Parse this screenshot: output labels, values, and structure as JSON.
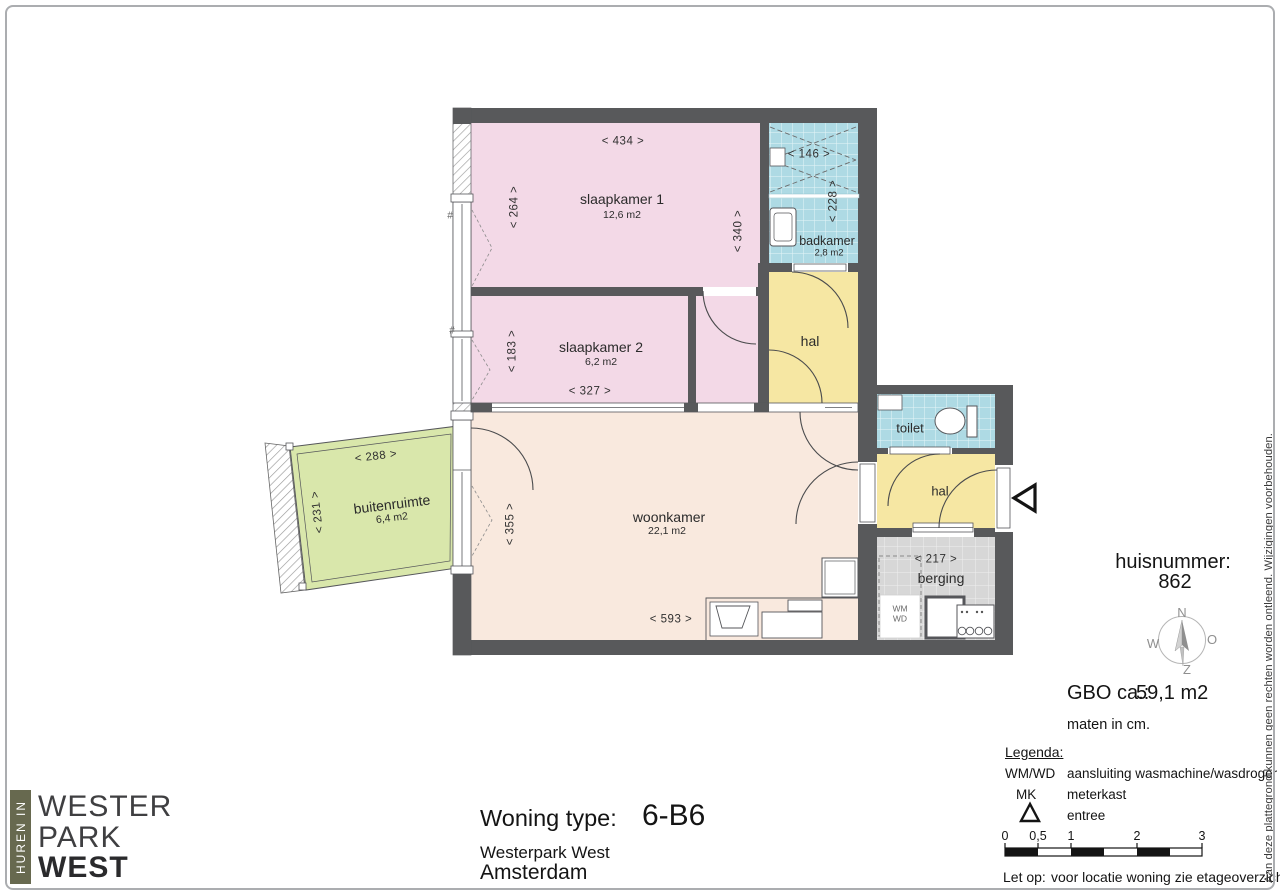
{
  "page": {
    "disclaimer": "Aan deze plattegrond kunnen geen rechten worden ontleend. Wijzigingen voorbehouden."
  },
  "plan": {
    "rooms": {
      "slaapkamer1": {
        "name": "slaapkamer 1",
        "area": "12,6 m2"
      },
      "slaapkamer2": {
        "name": "slaapkamer 2",
        "area": "6,2 m2"
      },
      "badkamer": {
        "name": "badkamer",
        "area": "2,8 m2"
      },
      "woonkamer": {
        "name": "woonkamer",
        "area": "22,1 m2"
      },
      "buitenruimte": {
        "name": "buitenruimte",
        "area": "6,4 m2"
      },
      "toilet": {
        "name": "toilet"
      },
      "hal_boven": {
        "name": "hal"
      },
      "hal_entree": {
        "name": "hal"
      },
      "berging": {
        "name": "berging"
      },
      "wasmachine": {
        "line1": "WM",
        "line2": "WD"
      }
    },
    "dims": {
      "d434": "<  434  >",
      "d264": "<  264  >",
      "d340": "<  340  >",
      "d146": "<  146  >",
      "d228": "<  228  >",
      "d183": "<  183  >",
      "d327": "<  327  >",
      "d355": "<  355  >",
      "d593": "<  593  >",
      "d288": "<  288  >",
      "d231": "<  231  >",
      "d217": "<  217  >"
    },
    "section_mark": "#"
  },
  "info": {
    "huisnummer_label": "huisnummer:",
    "huisnummer": "862",
    "gbo_label": "GBO ca.:",
    "gbo_value": "59,1 m2",
    "maten": "maten in cm.",
    "compass": {
      "n": "N",
      "o": "O",
      "z": "Z",
      "w": "W"
    }
  },
  "legend": {
    "title": "Legenda:",
    "wmwd_key": "WM/WD",
    "wmwd_desc": "aansluiting wasmachine/wasdroger",
    "mk_key": "MK",
    "mk_desc": "meterkast",
    "entree_desc": "entree",
    "scalebar": [
      "0",
      "0,5",
      "1",
      "2",
      "3"
    ],
    "letop_label": "Let op:",
    "letop_text": "voor locatie woning zie etageoverzicht."
  },
  "footer": {
    "type_label": "Woning type:",
    "type_value": "6-B6",
    "project": "Westerpark West",
    "city": "Amsterdam"
  },
  "logo": {
    "vertical": "HUREN IN",
    "line1": "WESTER",
    "line2": "PARK",
    "line3": "WEST"
  }
}
